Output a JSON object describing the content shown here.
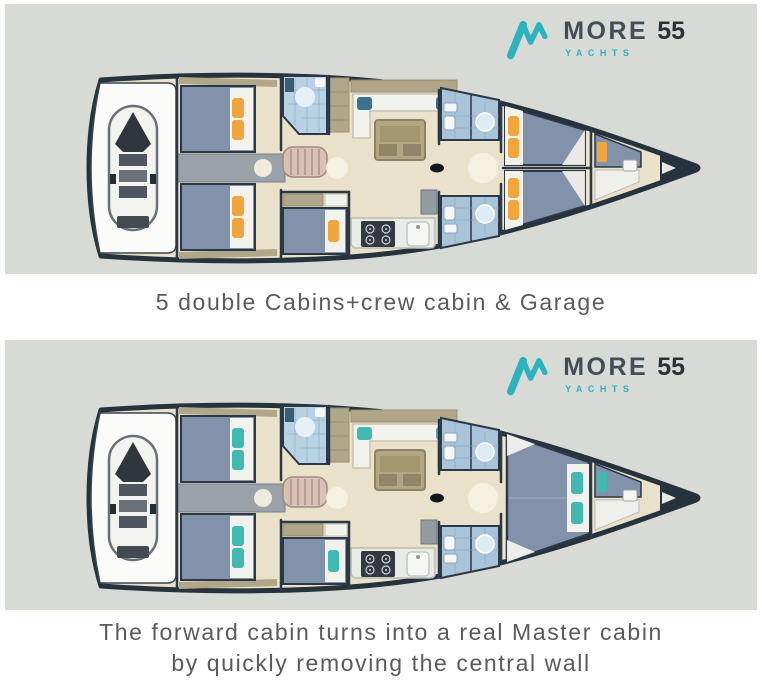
{
  "brand": {
    "name": "MORE",
    "model": "55",
    "subtitle": "YACHTS"
  },
  "panels": [
    {
      "caption": "5 double Cabins+crew cabin & Garage",
      "forward_layout": "two-cabins",
      "accent_color": "#f0a63c",
      "cushion_color": "#3a7390"
    },
    {
      "caption_lines": [
        "The forward cabin turns into a real Master cabin",
        "by quickly removing the central wall"
      ],
      "forward_layout": "master-cabin",
      "accent_color": "#41b9b0",
      "cushion_color": "#41b9b0"
    }
  ],
  "colors": {
    "panel_bg": "#d8dad6",
    "caption_text": "#595a5c",
    "brand_teal": "#2cb3bf",
    "brand_dark": "#414e59",
    "brand_model": "#2b3137",
    "hull_outline": "#26323c",
    "floor": "#e9e1ca",
    "wood": "#b0a78a",
    "wood_dark": "#9a8f73",
    "corridor": "#9aa1a8",
    "bed": "#8292ab",
    "bed_outline": "#2c3845",
    "white_soft": "#f2f2ed",
    "bath_tile": "#b8d2e4",
    "bath_tile_deep": "#a9c3d8",
    "tile_line": "#84a6c2",
    "galley_counter": "#e9ebe7",
    "stove": "#33393e",
    "stairs": "#d8c2b8",
    "stairs_line": "#9d8b80",
    "tender_body": "#f3f3f0",
    "tender_dark": "#2f363c"
  }
}
